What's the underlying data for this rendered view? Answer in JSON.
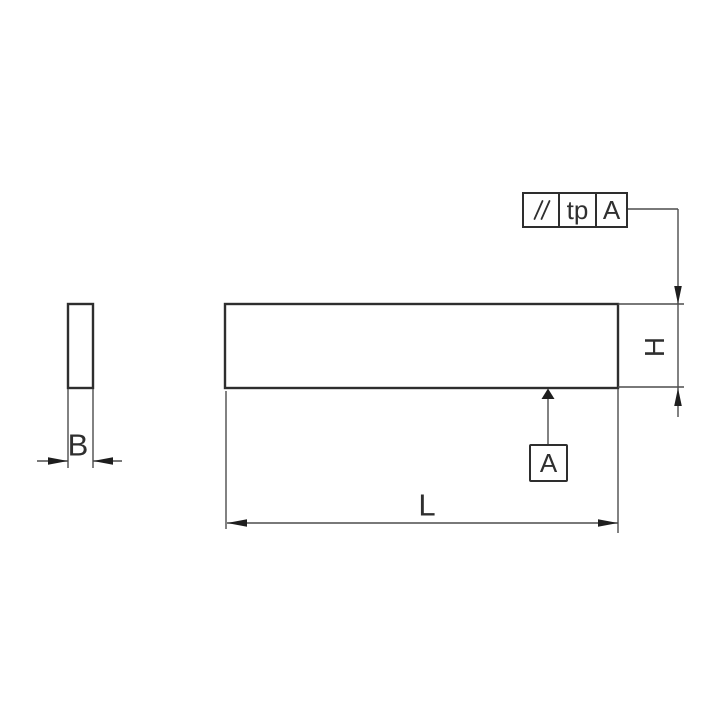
{
  "drawing": {
    "type": "dimension-drawing",
    "feature_control_frame": {
      "symbol_icon": "parallelism",
      "tolerance_label": "tp",
      "datum_ref_label": "A"
    },
    "datum": {
      "label": "A"
    },
    "dim_labels": {
      "width": "B",
      "height": "H",
      "length": "L"
    },
    "colors": {
      "outline": "#2e2e2e",
      "line": "#4d4d4d",
      "arrow": "#1e1e1e",
      "text": "#2f2f2f",
      "background": "#ffffff"
    }
  }
}
